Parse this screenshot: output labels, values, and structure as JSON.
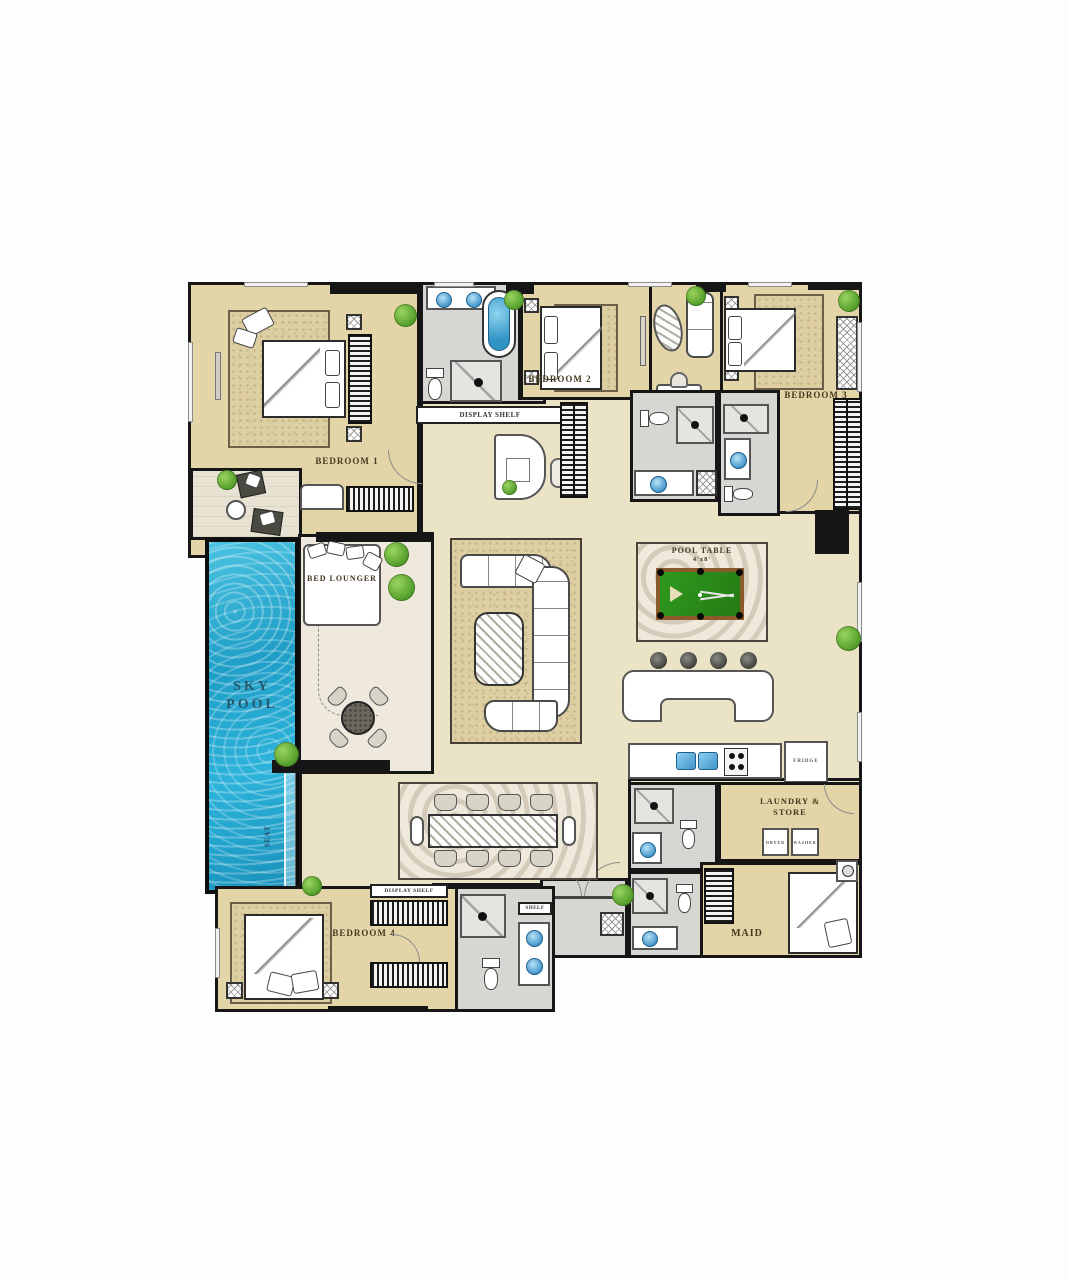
{
  "plan": {
    "colors": {
      "wall": "#161616",
      "floor_main": "#ebe3c6",
      "floor_bedroom": "#e4d5a9",
      "floor_bath": "#d8d6d2",
      "floor_deck": "#efe9dd",
      "pool_water": "#2fb0d4",
      "pool_table_felt": "#2f8f1f",
      "plant_green": "#55a02c",
      "sink_blue": "#4a9fd4",
      "label_brown": "#44381f",
      "label_pool_blue": "#27576e"
    },
    "labels": {
      "bedroom1": "BEDROOM 1",
      "bedroom2": "BEDROOM 2",
      "bedroom3": "BEDROOM 3",
      "bedroom4": "BEDROOM 4",
      "sky_pool": "SKY POOL",
      "seat": "SEAT",
      "bed_lounger": "BED LOUNGER",
      "pool_table": "POOL TABLE",
      "pool_table_size": "4'x8'",
      "display_shelf": "DISPLAY SHELF",
      "shelf": "SHELF",
      "laundry_store": "LAUNDRY & STORE",
      "maid": "MAID",
      "dryer": "DRYER",
      "washer": "WASHER",
      "fridge": "FRIDGE"
    }
  }
}
